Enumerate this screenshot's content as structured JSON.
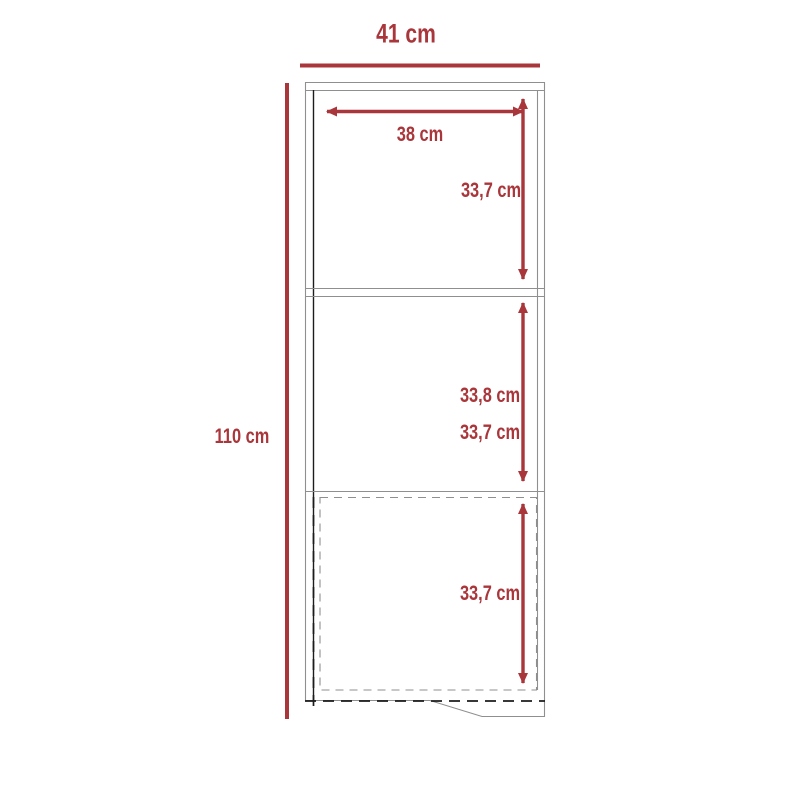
{
  "labels": {
    "overall_width": "41 cm",
    "overall_height": "110 cm",
    "shelf_inner_width": "38 cm",
    "top_section_height": "33,7 cm",
    "middle_section_height_primary": "33,8 cm",
    "middle_section_height_secondary": "33,7 cm",
    "bottom_section_height": "33,7 cm"
  },
  "colors": {
    "dimension_red": "#A9363A",
    "outline_gray": "#8F8F8F",
    "outline_dark": "#1C1C1C",
    "background": "#FFFFFF"
  }
}
